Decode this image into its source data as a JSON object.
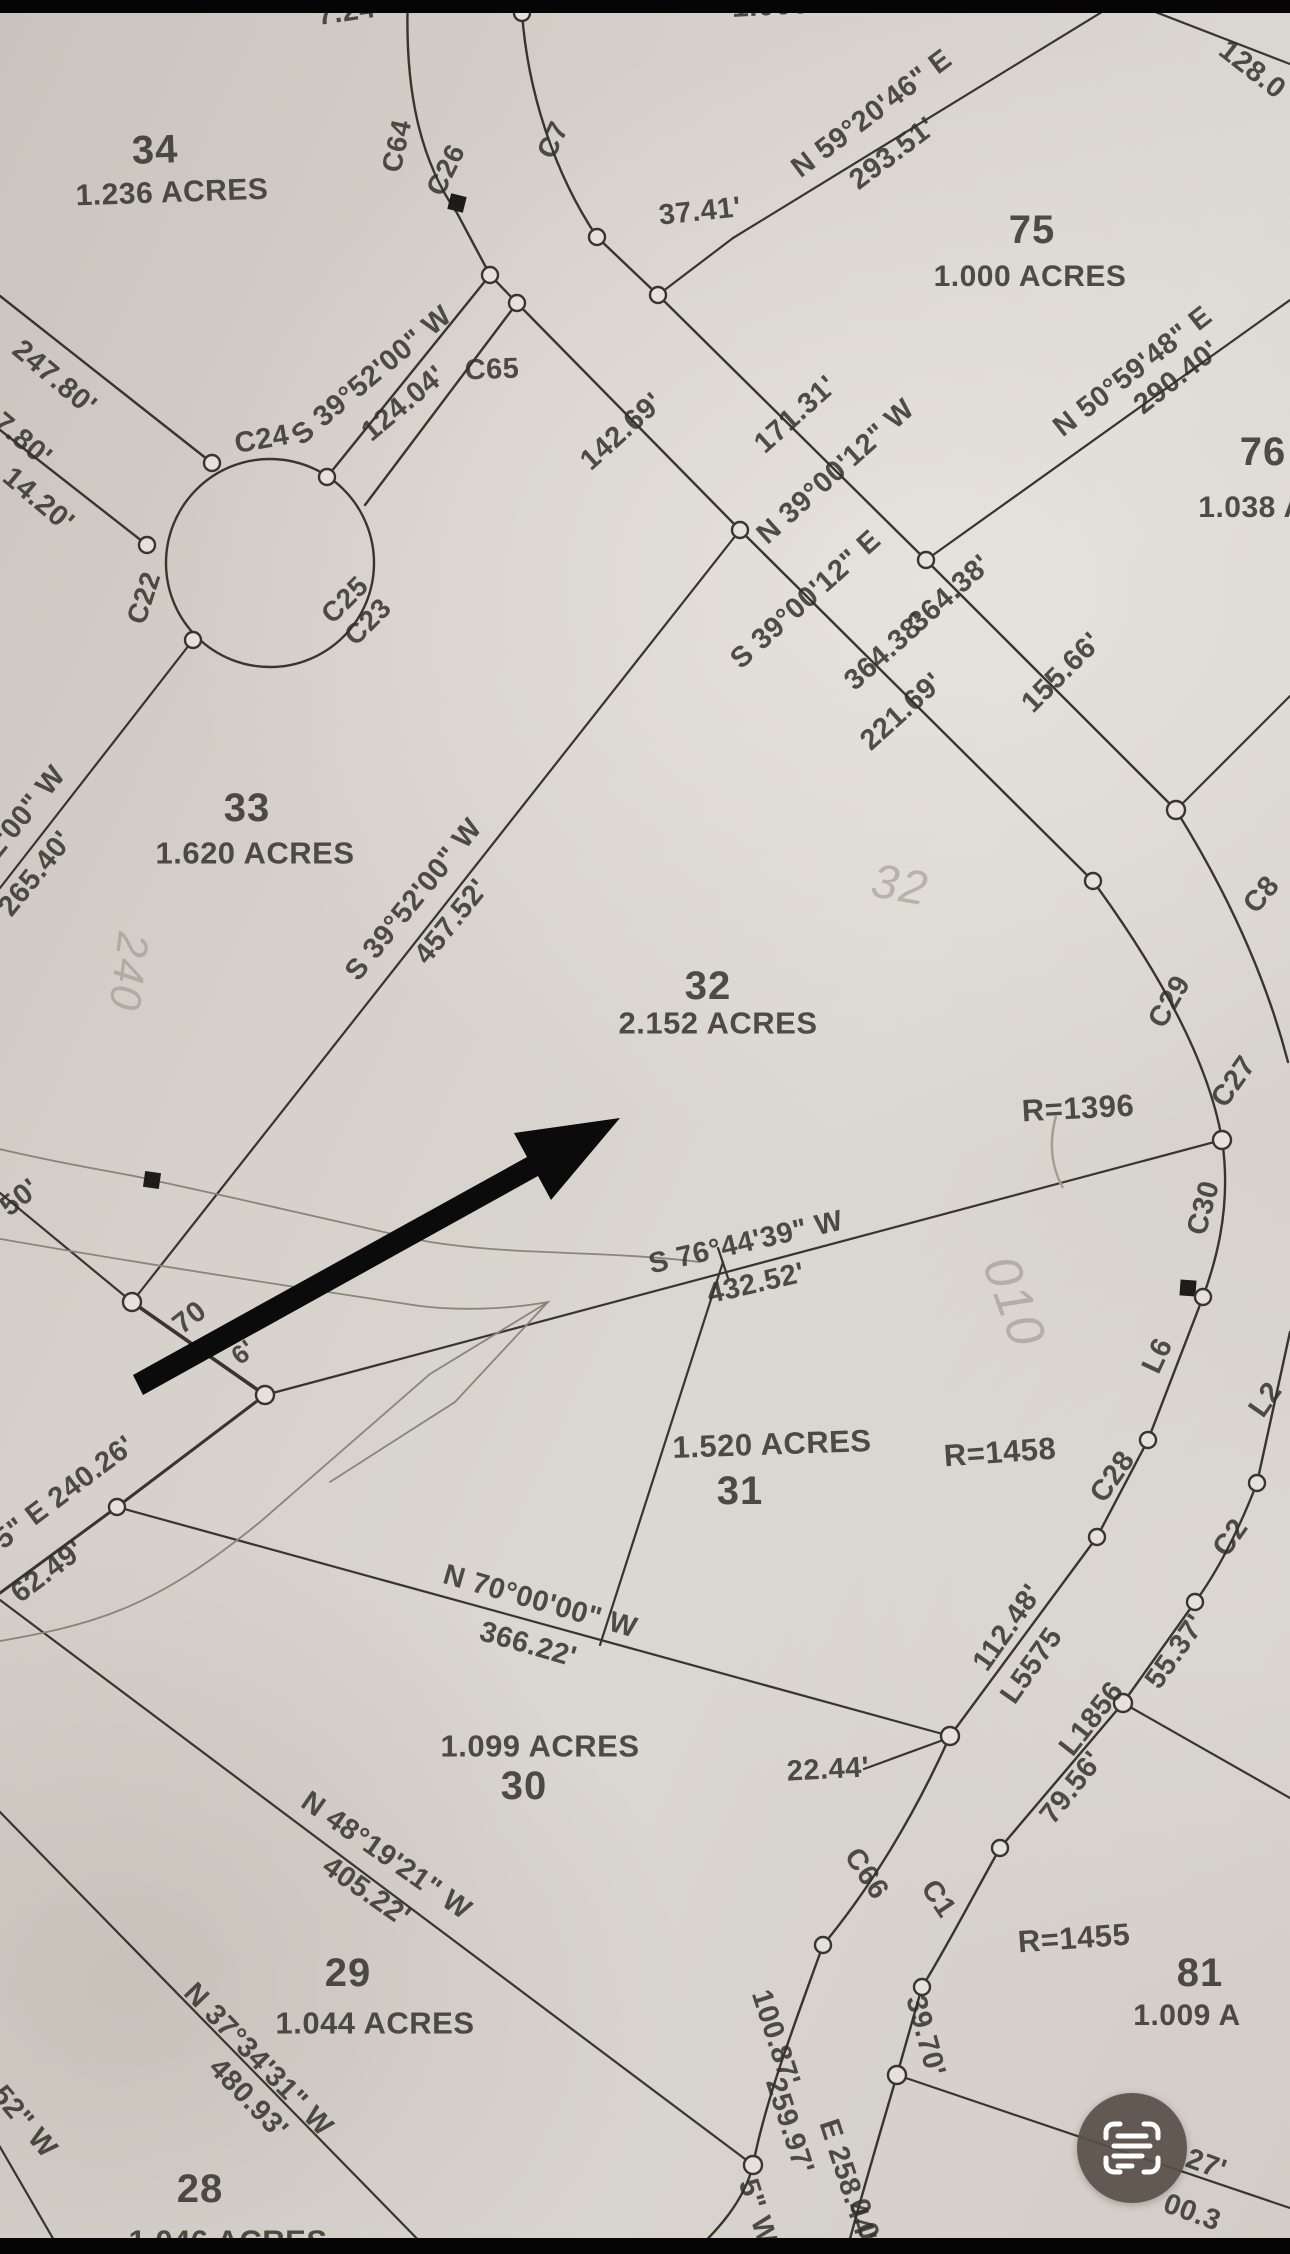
{
  "screen": {
    "width": 1290,
    "height": 2254,
    "letterbox_color": "#050505",
    "paper_color": "#d5d0c9",
    "line_color": "#38342f",
    "annotation_arrow_color": "#0b0b0b"
  },
  "fab": {
    "icon": "scan-text-icon",
    "bg_color": "#585049",
    "icon_color": "#ffffff"
  },
  "map": {
    "type": "plat-survey-map",
    "labels": [
      {
        "t": "7.24'",
        "x": 350,
        "y": 12,
        "r": -8,
        "s": 29,
        "cls": "dim"
      },
      {
        "t": "1.000 ACRES",
        "x": 828,
        "y": 3,
        "r": -3,
        "s": 30,
        "cls": "area"
      },
      {
        "t": "34",
        "x": 155,
        "y": 150,
        "r": -2,
        "s": 40,
        "cls": "lot"
      },
      {
        "t": "1.236 ACRES",
        "x": 172,
        "y": 193,
        "r": -2,
        "s": 30,
        "cls": "area"
      },
      {
        "t": "C64",
        "x": 397,
        "y": 146,
        "r": -78,
        "s": 28,
        "cls": "curve"
      },
      {
        "t": "C26",
        "x": 446,
        "y": 170,
        "r": -64,
        "s": 28,
        "cls": "curve"
      },
      {
        "t": "C7",
        "x": 553,
        "y": 140,
        "r": -65,
        "s": 28,
        "cls": "curve"
      },
      {
        "t": "37.41'",
        "x": 700,
        "y": 212,
        "r": -6,
        "s": 29,
        "cls": "dim"
      },
      {
        "t": "N 59°20'46\" E",
        "x": 872,
        "y": 114,
        "r": -37,
        "s": 29,
        "cls": "bearing"
      },
      {
        "t": "293.51'",
        "x": 893,
        "y": 154,
        "r": -37,
        "s": 29,
        "cls": "dim"
      },
      {
        "t": "75",
        "x": 1032,
        "y": 230,
        "r": 0,
        "s": 40,
        "cls": "lot"
      },
      {
        "t": "1.000 ACRES",
        "x": 1030,
        "y": 277,
        "r": 0,
        "s": 30,
        "cls": "area"
      },
      {
        "t": "128.0",
        "x": 1252,
        "y": 70,
        "r": 38,
        "s": 29,
        "cls": "dim"
      },
      {
        "t": "N 50°59'48\" E",
        "x": 1133,
        "y": 372,
        "r": -38,
        "s": 29,
        "cls": "bearing"
      },
      {
        "t": "290.40'",
        "x": 1177,
        "y": 378,
        "r": -38,
        "s": 29,
        "cls": "dim"
      },
      {
        "t": "76",
        "x": 1263,
        "y": 452,
        "r": 0,
        "s": 40,
        "cls": "lot"
      },
      {
        "t": "1.038 A",
        "x": 1252,
        "y": 508,
        "r": 0,
        "s": 30,
        "cls": "area"
      },
      {
        "t": "155.66'",
        "x": 1062,
        "y": 673,
        "r": -45,
        "s": 29,
        "cls": "dim"
      },
      {
        "t": "247.80'",
        "x": 54,
        "y": 378,
        "r": 40,
        "s": 29,
        "cls": "dim"
      },
      {
        "t": "7.80'",
        "x": 22,
        "y": 440,
        "r": 40,
        "s": 29,
        "cls": "dim"
      },
      {
        "t": "14.20'",
        "x": 38,
        "y": 500,
        "r": 40,
        "s": 29,
        "cls": "dim"
      },
      {
        "t": "C24",
        "x": 262,
        "y": 440,
        "r": -10,
        "s": 29,
        "cls": "curve"
      },
      {
        "t": "C22",
        "x": 144,
        "y": 598,
        "r": -72,
        "s": 28,
        "cls": "curve"
      },
      {
        "t": "C25",
        "x": 345,
        "y": 600,
        "r": -45,
        "s": 28,
        "cls": "curve"
      },
      {
        "t": "C23",
        "x": 368,
        "y": 622,
        "r": -45,
        "s": 28,
        "cls": "curve"
      },
      {
        "t": "S 39°52'00\" W",
        "x": 372,
        "y": 376,
        "r": -40,
        "s": 29,
        "cls": "bearing"
      },
      {
        "t": "124.04'",
        "x": 404,
        "y": 404,
        "r": -40,
        "s": 29,
        "cls": "dim"
      },
      {
        "t": "C65",
        "x": 492,
        "y": 370,
        "r": -2,
        "s": 29,
        "cls": "curve"
      },
      {
        "t": "142.69'",
        "x": 622,
        "y": 432,
        "r": -42,
        "s": 29,
        "cls": "dim"
      },
      {
        "t": "171.31'",
        "x": 796,
        "y": 415,
        "r": -42,
        "s": 29,
        "cls": "dim"
      },
      {
        "t": "N 39°00'12\" W",
        "x": 836,
        "y": 472,
        "r": -42,
        "s": 29,
        "cls": "bearing"
      },
      {
        "t": "364.38'",
        "x": 950,
        "y": 594,
        "r": -42,
        "s": 29,
        "cls": "dim"
      },
      {
        "t": "S 39°00'12\" E",
        "x": 806,
        "y": 600,
        "r": -42,
        "s": 29,
        "cls": "bearing"
      },
      {
        "t": "364.38'",
        "x": 886,
        "y": 652,
        "r": -42,
        "s": 29,
        "cls": "dim"
      },
      {
        "t": "221.69'",
        "x": 902,
        "y": 712,
        "r": -42,
        "s": 29,
        "cls": "dim"
      },
      {
        "t": "C8",
        "x": 1262,
        "y": 895,
        "r": -50,
        "s": 29,
        "cls": "curve"
      },
      {
        "t": "33",
        "x": 247,
        "y": 808,
        "r": 0,
        "s": 40,
        "cls": "lot"
      },
      {
        "t": "1.620 ACRES",
        "x": 255,
        "y": 853,
        "r": 0,
        "s": 31,
        "cls": "area"
      },
      {
        "t": "2'00\" W",
        "x": 26,
        "y": 812,
        "r": -51,
        "s": 29,
        "cls": "bearing"
      },
      {
        "t": "265.40'",
        "x": 36,
        "y": 874,
        "r": -51,
        "s": 29,
        "cls": "dim"
      },
      {
        "t": "S 39°52'00\" W",
        "x": 414,
        "y": 900,
        "r": -51,
        "s": 29,
        "cls": "bearing"
      },
      {
        "t": "457.52'",
        "x": 452,
        "y": 922,
        "r": -51,
        "s": 29,
        "cls": "dim"
      },
      {
        "t": "32",
        "x": 708,
        "y": 986,
        "r": 0,
        "s": 40,
        "cls": "lot"
      },
      {
        "t": "2.152 ACRES",
        "x": 718,
        "y": 1023,
        "r": 0,
        "s": 31,
        "cls": "area"
      },
      {
        "t": "C29",
        "x": 1170,
        "y": 1002,
        "r": -60,
        "s": 29,
        "cls": "curve"
      },
      {
        "t": "C27",
        "x": 1234,
        "y": 1082,
        "r": -55,
        "s": 29,
        "cls": "curve"
      },
      {
        "t": "R=1396",
        "x": 1078,
        "y": 1108,
        "r": -3,
        "s": 31,
        "cls": "radius"
      },
      {
        "t": "C30",
        "x": 1204,
        "y": 1208,
        "r": -75,
        "s": 29,
        "cls": "curve"
      },
      {
        "t": "L6",
        "x": 1158,
        "y": 1356,
        "r": -65,
        "s": 29,
        "cls": "curve"
      },
      {
        "t": "L2",
        "x": 1266,
        "y": 1400,
        "r": -55,
        "s": 29,
        "cls": "curve"
      },
      {
        "t": "S 76°44'39\" W",
        "x": 746,
        "y": 1243,
        "r": -13,
        "s": 29,
        "cls": "bearing"
      },
      {
        "t": "432.52'",
        "x": 756,
        "y": 1284,
        "r": -13,
        "s": 29,
        "cls": "dim"
      },
      {
        "t": "50'",
        "x": 20,
        "y": 1198,
        "r": -38,
        "s": 29,
        "cls": "dim"
      },
      {
        "t": "70",
        "x": 190,
        "y": 1318,
        "r": -38,
        "s": 29,
        "cls": "dim"
      },
      {
        "t": "6'",
        "x": 243,
        "y": 1352,
        "r": -38,
        "s": 26,
        "cls": "dim"
      },
      {
        "t": "55\" E 240.26'",
        "x": 58,
        "y": 1498,
        "r": -37,
        "s": 29,
        "cls": "bearing"
      },
      {
        "t": "62.49'",
        "x": 48,
        "y": 1572,
        "r": -37,
        "s": 29,
        "cls": "dim"
      },
      {
        "t": "1.520 ACRES",
        "x": 772,
        "y": 1444,
        "r": -2,
        "s": 31,
        "cls": "area"
      },
      {
        "t": "31",
        "x": 740,
        "y": 1491,
        "r": 0,
        "s": 40,
        "cls": "lot"
      },
      {
        "t": "R=1458",
        "x": 1000,
        "y": 1452,
        "r": -4,
        "s": 31,
        "cls": "radius"
      },
      {
        "t": "C28",
        "x": 1113,
        "y": 1477,
        "r": -55,
        "s": 29,
        "cls": "curve"
      },
      {
        "t": "C2",
        "x": 1231,
        "y": 1538,
        "r": -55,
        "s": 29,
        "cls": "curve"
      },
      {
        "t": "55.37'",
        "x": 1176,
        "y": 1652,
        "r": -55,
        "s": 29,
        "cls": "dim"
      },
      {
        "t": "112.48'",
        "x": 1008,
        "y": 1628,
        "r": -55,
        "s": 29,
        "cls": "dim"
      },
      {
        "t": "L5575",
        "x": 1032,
        "y": 1666,
        "r": -55,
        "s": 29,
        "cls": "curve"
      },
      {
        "t": "L1856",
        "x": 1092,
        "y": 1719,
        "r": -52,
        "s": 29,
        "cls": "curve"
      },
      {
        "t": "79.56'",
        "x": 1072,
        "y": 1788,
        "r": -52,
        "s": 29,
        "cls": "dim"
      },
      {
        "t": "N 70°00'00\" W",
        "x": 540,
        "y": 1602,
        "r": 16,
        "s": 29,
        "cls": "bearing"
      },
      {
        "t": "366.22'",
        "x": 528,
        "y": 1645,
        "r": 16,
        "s": 29,
        "cls": "dim"
      },
      {
        "t": "1.099 ACRES",
        "x": 540,
        "y": 1746,
        "r": 0,
        "s": 31,
        "cls": "area"
      },
      {
        "t": "30",
        "x": 524,
        "y": 1786,
        "r": 0,
        "s": 40,
        "cls": "lot"
      },
      {
        "t": "22.44'",
        "x": 828,
        "y": 1770,
        "r": -3,
        "s": 29,
        "cls": "dim"
      },
      {
        "t": "C66",
        "x": 866,
        "y": 1874,
        "r": 56,
        "s": 29,
        "cls": "curve"
      },
      {
        "t": "C1",
        "x": 938,
        "y": 1899,
        "r": 56,
        "s": 29,
        "cls": "curve"
      },
      {
        "t": "R=1455",
        "x": 1074,
        "y": 1938,
        "r": -4,
        "s": 31,
        "cls": "radius"
      },
      {
        "t": "81",
        "x": 1200,
        "y": 1973,
        "r": 0,
        "s": 40,
        "cls": "lot"
      },
      {
        "t": "1.009 A",
        "x": 1187,
        "y": 2016,
        "r": 0,
        "s": 30,
        "cls": "area"
      },
      {
        "t": "N 48°19'21\" W",
        "x": 386,
        "y": 1856,
        "r": 35,
        "s": 29,
        "cls": "bearing"
      },
      {
        "t": "405.22'",
        "x": 366,
        "y": 1892,
        "r": 35,
        "s": 29,
        "cls": "dim"
      },
      {
        "t": "29",
        "x": 348,
        "y": 1973,
        "r": 0,
        "s": 40,
        "cls": "lot"
      },
      {
        "t": "1.044 ACRES",
        "x": 375,
        "y": 2023,
        "r": 0,
        "s": 31,
        "cls": "area"
      },
      {
        "t": "N 37°34'31\" W",
        "x": 258,
        "y": 2060,
        "r": 46,
        "s": 29,
        "cls": "bearing"
      },
      {
        "t": "480.93'",
        "x": 248,
        "y": 2099,
        "r": 46,
        "s": 29,
        "cls": "dim"
      },
      {
        "t": "28",
        "x": 200,
        "y": 2189,
        "r": 0,
        "s": 40,
        "cls": "lot"
      },
      {
        "t": "1.046 ACRES",
        "x": 228,
        "y": 2241,
        "r": 0,
        "s": 31,
        "cls": "area"
      },
      {
        "t": "52\" W",
        "x": 24,
        "y": 2122,
        "r": 50,
        "s": 29,
        "cls": "bearing"
      },
      {
        "t": "100.87'",
        "x": 775,
        "y": 2038,
        "r": 72,
        "s": 29,
        "cls": "dim"
      },
      {
        "t": "259.97'",
        "x": 789,
        "y": 2126,
        "r": 72,
        "s": 29,
        "cls": "dim"
      },
      {
        "t": "5\" W",
        "x": 757,
        "y": 2212,
        "r": 72,
        "s": 29,
        "cls": "bearing"
      },
      {
        "t": "E 258.44'",
        "x": 847,
        "y": 2181,
        "r": 72,
        "s": 29,
        "cls": "dim"
      },
      {
        "t": "0.00'",
        "x": 867,
        "y": 2231,
        "r": 72,
        "s": 29,
        "cls": "dim"
      },
      {
        "t": "39.70'",
        "x": 925,
        "y": 2036,
        "r": 75,
        "s": 29,
        "cls": "dim"
      },
      {
        "t": "27'",
        "x": 1206,
        "y": 2165,
        "r": 20,
        "s": 29,
        "cls": "dim"
      },
      {
        "t": "00.3",
        "x": 1192,
        "y": 2213,
        "r": 20,
        "s": 29,
        "cls": "dim"
      },
      {
        "t": "240",
        "x": 128,
        "y": 972,
        "r": 97,
        "s": 44,
        "cls": "hand"
      },
      {
        "t": "32",
        "x": 900,
        "y": 886,
        "r": 10,
        "s": 48,
        "cls": "hand"
      },
      {
        "t": "010",
        "x": 1014,
        "y": 1302,
        "r": 70,
        "s": 52,
        "cls": "hand"
      }
    ]
  }
}
